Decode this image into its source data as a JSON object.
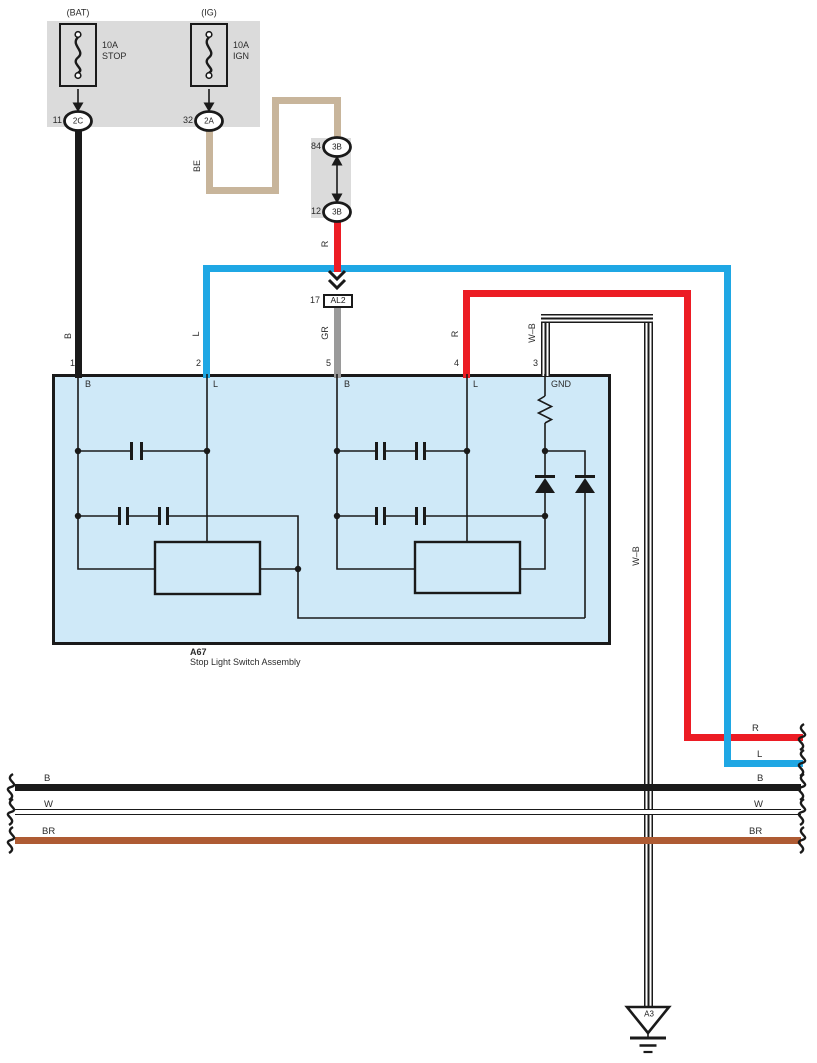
{
  "colors": {
    "red": "#EC1C24",
    "blue": "#1FA7E4",
    "beige": "#C8B59B",
    "brown": "#AE5B33",
    "gray_wire": "#9A9A9A",
    "assembly_fill": "#CFE9F8",
    "panel_fill": "#DBDBDB"
  },
  "fuse_panel": {
    "bat_label": "(BAT)",
    "bat_rating": "10A",
    "bat_name": "STOP",
    "bat_pin": "11",
    "bat_connector": "2C",
    "ig_label": "(IG)",
    "ig_rating": "10A",
    "ig_name": "IGN",
    "ig_pin": "32",
    "ig_connector": "2A"
  },
  "junction": {
    "top_pin": "84",
    "top_connector": "3B",
    "bottom_pin": "12",
    "bottom_connector": "3B"
  },
  "al2": {
    "pin": "17",
    "label": "AL2"
  },
  "wires": {
    "b": "B",
    "be": "BE",
    "r_top": "R",
    "gr": "GR",
    "l": "L",
    "r_right": "R",
    "wb_top": "W–B",
    "wb_down": "W–B"
  },
  "assembly": {
    "code": "A67",
    "name": "Stop Light Switch Assembly",
    "pins": [
      {
        "num": "1",
        "label": "B"
      },
      {
        "num": "2",
        "label": "L"
      },
      {
        "num": "5",
        "label": "B"
      },
      {
        "num": "4",
        "label": "L"
      },
      {
        "num": "3",
        "label": "GND"
      }
    ]
  },
  "bus": {
    "left": [
      "B",
      "W",
      "BR"
    ],
    "right": [
      "R",
      "L",
      "B",
      "W",
      "BR"
    ]
  },
  "ground": {
    "label": "A3"
  }
}
